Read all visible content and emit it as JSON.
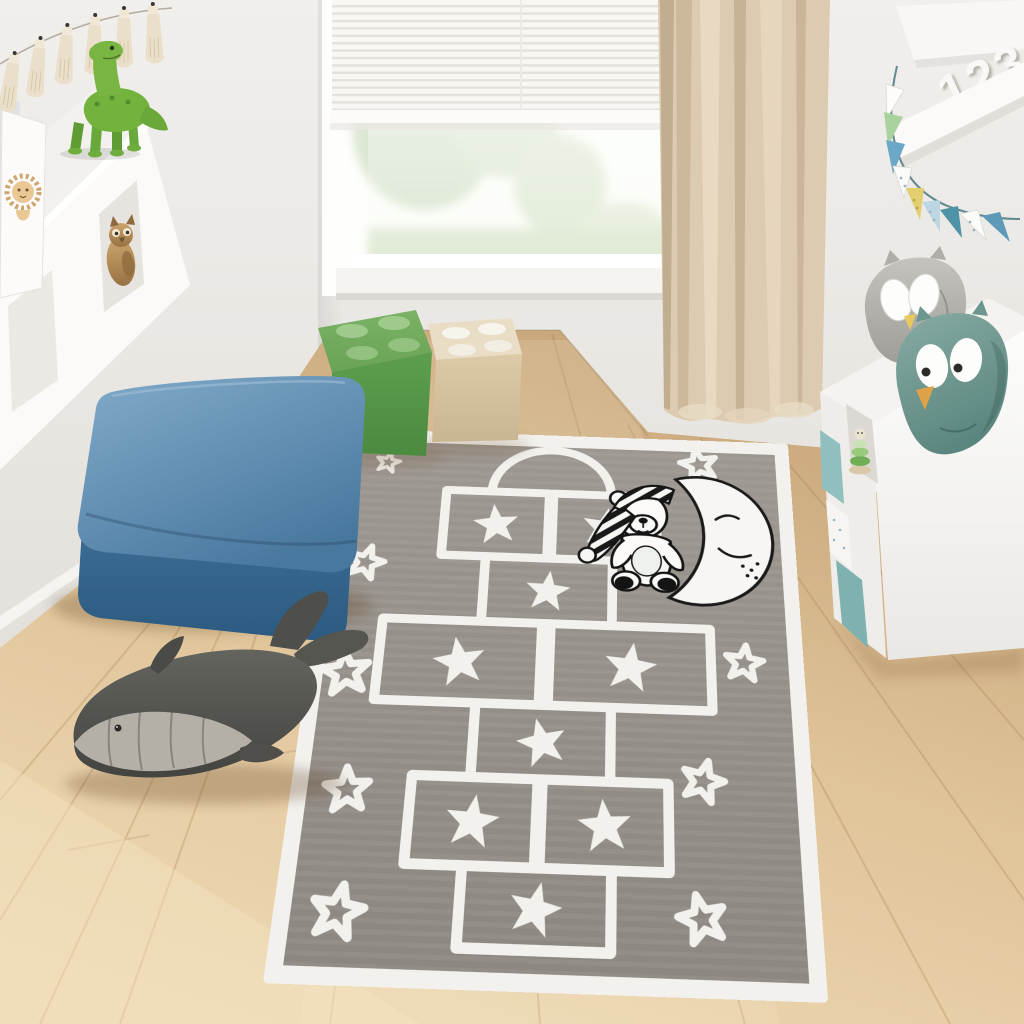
{
  "scene": {
    "setting": "children's playroom",
    "wall_color": "#e8e5e1",
    "floor": "light oak plank floor",
    "floor_color": "#dfc094",
    "daylight_window": true
  },
  "window": {
    "blinds": "white venetian blinds lowered over upper part",
    "view": "pale green treetops",
    "frame_color": "#ffffff"
  },
  "curtain": {
    "color": "#dccab1",
    "position": "right of window, floor length"
  },
  "rug": {
    "type": "hopscotch play rug",
    "field_color": "#97918b",
    "motif_color": "#f2f1ed",
    "border": "white band",
    "hopscotch_boxes": 9,
    "solid_stars_in_boxes": 9,
    "outline_stars_scattered": 9,
    "corner_motif": "teddy bear with striped nightcap sitting on smiling crescent moon",
    "moon_face": "closed eye, smile, freckles"
  },
  "furniture": {
    "ottoman": {
      "color": "#4f7da4",
      "material": "velvet",
      "shape": "square pouf"
    },
    "left_wall_shelf": {
      "color": "#ffffff",
      "contents": [
        "picture frames",
        "green dinosaur toy",
        "wooden owl figurine"
      ]
    },
    "right_cube_shelf": {
      "color": "#ffffff",
      "contents": [
        "green stacking toy",
        "teal storage bins",
        "white dotted box"
      ],
      "on_top": [
        "grey owl plush",
        "teal owl plush"
      ]
    }
  },
  "toys": {
    "dinosaur": {
      "color": "#74b23e",
      "type": "sauropod figure"
    },
    "whale_plush": {
      "body_color": "#55554f",
      "belly_color": "#b5b0a7"
    },
    "lego_storage_boxes": [
      {
        "color": "#5d9e4e"
      },
      {
        "color": "#dcc9a9"
      }
    ],
    "owl_plushes": [
      {
        "color": "#a3a19c"
      },
      {
        "color": "#6f9a93"
      }
    ]
  },
  "decor": {
    "shelf_numbers": "123",
    "bunting_flag_colors": [
      "#ffffff",
      "#a9d39e",
      "#6ba7c6",
      "#ffffff",
      "#e3cf6f",
      "#bcd6e4",
      "#4f93a6",
      "#ffffff",
      "#5e9ab8"
    ],
    "tassel_garland": {
      "tassel_color": "#e9dfca",
      "count_visible": 6
    }
  }
}
